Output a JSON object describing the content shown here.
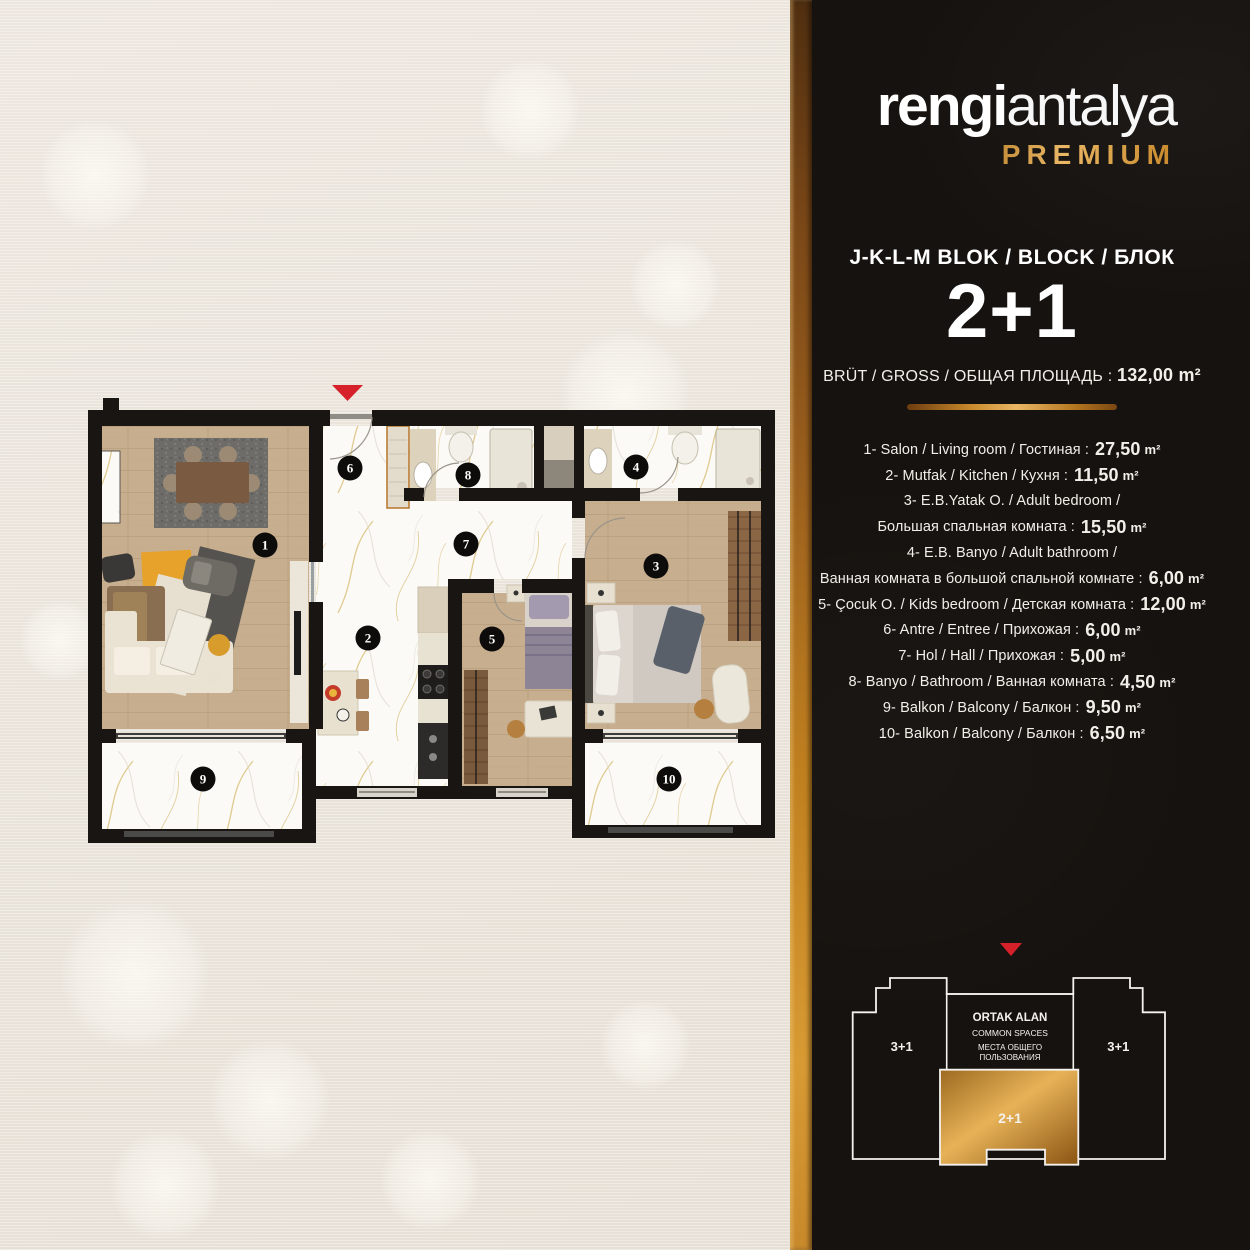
{
  "brand": {
    "name_bold": "rengi",
    "name_light": "antalya",
    "premium": "PREMIUM"
  },
  "header": {
    "block_line": "J-K-L-M BLOK / BLOCK / БЛОК",
    "unit_type": "2+1",
    "gross_label": "BRÜT / GROSS / ОБЩАЯ ПЛОЩАДЬ :",
    "gross_value": "132,00",
    "unit": "m²"
  },
  "rooms": [
    {
      "text": "1- Salon / Living room / Гостиная :",
      "area": "27,50"
    },
    {
      "text": "2- Mutfak / Kitchen / Кухня :",
      "area": "11,50"
    },
    {
      "text": "3- E.B.Yatak O. / Adult bedroom /",
      "area": null
    },
    {
      "text": "Большая спальная комната :",
      "area": "15,50"
    },
    {
      "text": "4- E.B. Banyo / Adult bathroom /",
      "area": null
    },
    {
      "text": "Ванная комната в большой спальной комнате :",
      "area": "6,00"
    },
    {
      "text": "5- Çocuk O. / Kids bedroom / Детская комната :",
      "area": "12,00"
    },
    {
      "text": "6- Antre / Entree / Прихожая :",
      "area": "6,00"
    },
    {
      "text": "7- Hol / Hall / Прихожая :",
      "area": "5,00"
    },
    {
      "text": "8- Banyo / Bathroom / Ванная комната :",
      "area": "4,50"
    },
    {
      "text": "9- Balkon / Balcony / Балкон :",
      "area": "9,50"
    },
    {
      "text": "10- Balkon / Balcony / Балкон :",
      "area": "6,50"
    }
  ],
  "plan": {
    "badges": [
      {
        "num": "1",
        "x": 177,
        "y": 162
      },
      {
        "num": "2",
        "x": 280,
        "y": 255
      },
      {
        "num": "3",
        "x": 568,
        "y": 183
      },
      {
        "num": "4",
        "x": 548,
        "y": 84
      },
      {
        "num": "5",
        "x": 404,
        "y": 256
      },
      {
        "num": "6",
        "x": 262,
        "y": 85
      },
      {
        "num": "7",
        "x": 378,
        "y": 161
      },
      {
        "num": "8",
        "x": 380,
        "y": 92
      },
      {
        "num": "9",
        "x": 115,
        "y": 396
      },
      {
        "num": "10",
        "x": 581,
        "y": 396
      }
    ]
  },
  "diagram": {
    "left_wing": "3+1",
    "right_wing": "3+1",
    "common_1": "ORTAK ALAN",
    "common_2": "COMMON SPACES",
    "common_3": "МЕСТА ОБЩЕГО",
    "common_4": "ПОЛЬЗОВАНИЯ",
    "unit_label": "2+1"
  },
  "colors": {
    "gold": "#c8892b",
    "panel_black": "#16120f",
    "beige": "#ece6dd",
    "entrance_red": "#d6212a"
  }
}
